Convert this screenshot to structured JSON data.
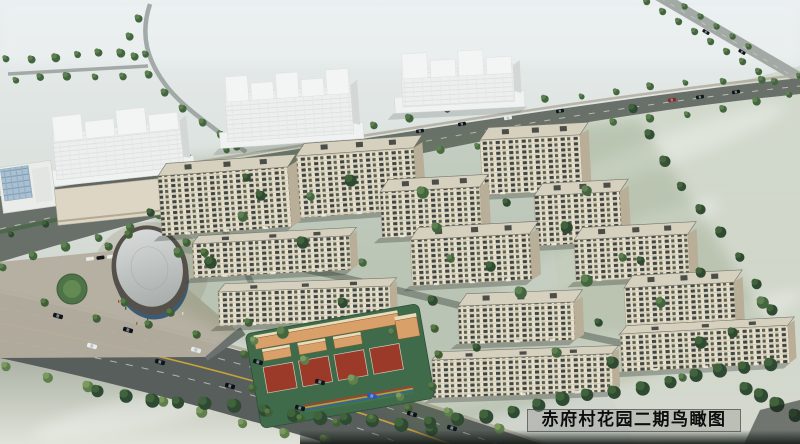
{
  "caption": {
    "text": "赤府村花园二期鸟瞰图"
  },
  "scene": {
    "palette": {
      "sky_top": "#e8edee",
      "land_mid": "#d3d9d2",
      "land_low": "#cfd4cc",
      "field_green": "#c3ccb6",
      "road_asphalt": "#575e5b",
      "boulevard_asphalt": "#687069",
      "road_centerline": "#c9a23c",
      "lane_dash": "#d8dbd8",
      "sidewalk": "#b2ac9e",
      "tree_dark": "#2e4a32",
      "tree_mid": "#44663f",
      "tree_light": "#5f7f4c",
      "facade_cream": "#e8e1cd",
      "facade_shade": "#b9ae97",
      "roof_pale": "#d6d0bf",
      "roof_trim": "#76756b",
      "rooftop_unit": "#4a4d48",
      "white_tower": "#edefee",
      "white_tower_shade": "#d3d8d7",
      "school_wall": "#d9a06a",
      "school_roof": "#e9dcba",
      "court_red": "#9c3a2a",
      "field_turf": "#3f6b4a",
      "oval_roof": "#c6c9c8",
      "oval_rim": "#55504a",
      "glass_blue": "#a9c0d2"
    },
    "white_towers": [
      {
        "x": 57,
        "y": 118,
        "w": 128,
        "h": 62,
        "towers": 4,
        "tilt": -6
      },
      {
        "x": 228,
        "y": 78,
        "w": 126,
        "h": 64,
        "towers": 5,
        "tilt": -4
      },
      {
        "x": 403,
        "y": 55,
        "w": 112,
        "h": 52,
        "towers": 4,
        "tilt": -3
      }
    ],
    "retail_podium": {
      "x": 56,
      "y": 184,
      "w": 104,
      "h": 36,
      "tilt": -6
    },
    "glass_building": {
      "x": 0,
      "y": 164,
      "w": 54,
      "h": 46,
      "tilt": -8
    },
    "oval_hall": {
      "cx": 150,
      "cy": 270,
      "rx": 37,
      "ry": 44,
      "tilt": -14
    },
    "school": {
      "x": 252,
      "y": 318,
      "w": 176,
      "h": 96,
      "tilt": -10,
      "courts": 4
    },
    "mid_rise": [
      {
        "x": 158,
        "y": 176,
        "w": 130,
        "h": 60,
        "tilt": -4
      },
      {
        "x": 296,
        "y": 156,
        "w": 118,
        "h": 62,
        "tilt": -4
      },
      {
        "x": 480,
        "y": 140,
        "w": 100,
        "h": 55,
        "tilt": -3
      },
      {
        "x": 380,
        "y": 192,
        "w": 100,
        "h": 46,
        "tilt": -3
      },
      {
        "x": 410,
        "y": 240,
        "w": 120,
        "h": 46,
        "tilt": -3
      },
      {
        "x": 534,
        "y": 196,
        "w": 86,
        "h": 50,
        "tilt": -3
      },
      {
        "x": 574,
        "y": 240,
        "w": 114,
        "h": 42,
        "tilt": -3
      },
      {
        "x": 624,
        "y": 288,
        "w": 110,
        "h": 42,
        "tilt": -3
      },
      {
        "x": 458,
        "y": 306,
        "w": 116,
        "h": 38,
        "tilt": -2
      }
    ],
    "low_rise": [
      {
        "x": 192,
        "y": 244,
        "w": 158,
        "h": 34,
        "tilt": -3
      },
      {
        "x": 218,
        "y": 292,
        "w": 172,
        "h": 34,
        "tilt": -2
      },
      {
        "x": 432,
        "y": 360,
        "w": 180,
        "h": 38,
        "tilt": -2
      },
      {
        "x": 620,
        "y": 334,
        "w": 168,
        "h": 38,
        "tilt": -3
      }
    ]
  }
}
